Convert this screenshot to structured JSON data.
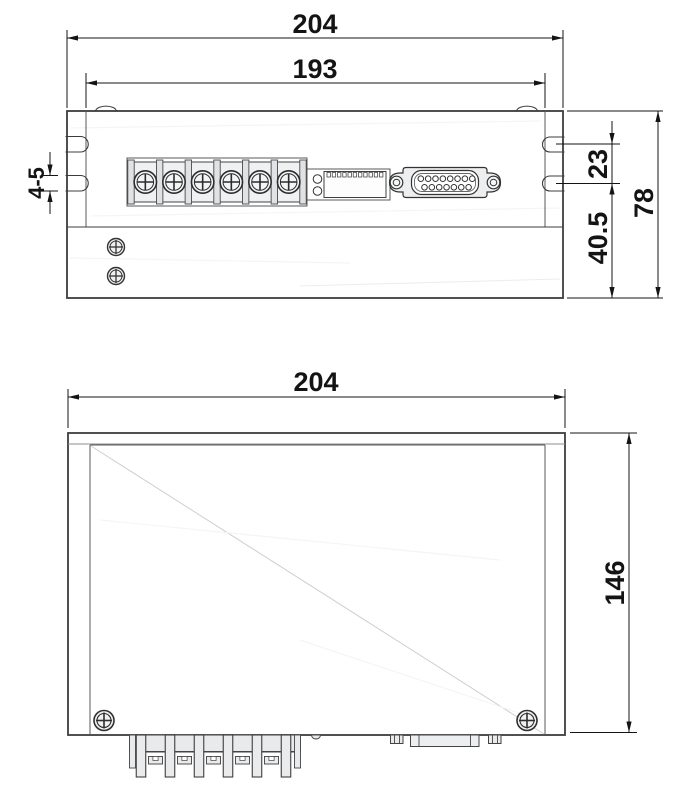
{
  "colors": {
    "background": "#ffffff",
    "body_fill": "#e9eaec",
    "panel_fill": "#f0f1f3",
    "outline_dark": "#3c3c3c",
    "dimension_color": "#141414",
    "white": "#ffffff"
  },
  "front_view": {
    "dimensions": {
      "overall_width": "204",
      "panel_width": "193",
      "slot_width": "4-5",
      "slot_spacing": "23",
      "base_height": "40.5",
      "overall_height": "78"
    }
  },
  "top_view": {
    "dimensions": {
      "overall_width": "204",
      "overall_depth": "146"
    }
  },
  "components": {
    "terminal_block": {
      "cells": 6
    },
    "dip_switch": {
      "teeth": 11,
      "indicator_holes": 2
    },
    "db_connector": {
      "holes_top_row": 8,
      "holes_bottom_row": 7
    },
    "bottom_terminal_pins": {
      "pins": 6,
      "tabs": 5
    },
    "mounting_slots": {
      "per_side": 2
    },
    "panel_screws": {
      "front": 2,
      "top": 2
    }
  }
}
